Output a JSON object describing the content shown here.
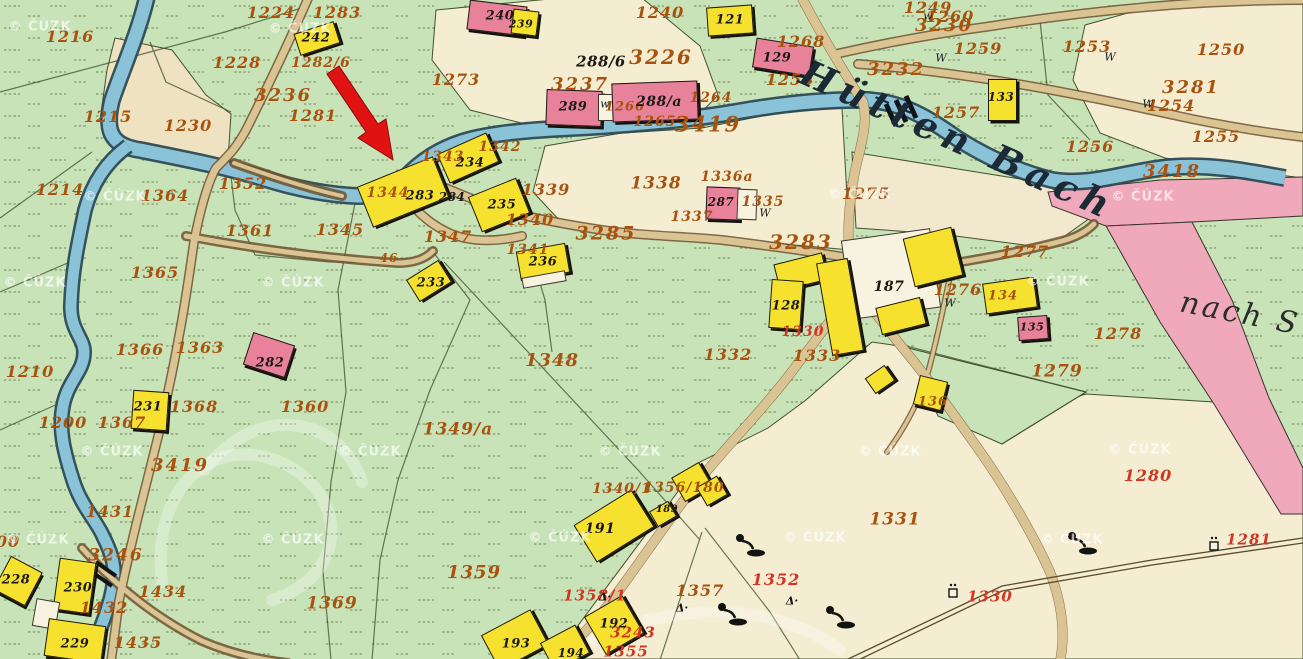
{
  "map": {
    "stream_name": "Hütten Bach",
    "road_destination": "nach S",
    "watermark_text": "© ČÚZK",
    "palette": {
      "meadow_green": "#c9e3b8",
      "field_cream": "#f4edd2",
      "field_tan": "#efe2c0",
      "road_fill": "#dbc493",
      "road_edge": "#6f522f",
      "stream_fill": "#8ac2d8",
      "stream_edge": "#2c4a55",
      "highway_pink": "#f0a9ba",
      "building_wood_yellow": "#f6e22e",
      "building_masonry_pink": "#e8819a",
      "ink_parcel_orange": "#a8520e",
      "ink_revision_red": "#d03622",
      "ink_house_black": "#1b1915",
      "annotation_arrow_red": "#e01212"
    },
    "annotation_arrow": {
      "points": "327,74 339,66 378,124 386,119 393,160 358,138 366,132",
      "color": "#e01212"
    },
    "labels": [
      {
        "t": "1216",
        "x": 70,
        "y": 37,
        "c": "o"
      },
      {
        "t": "1224",
        "x": 271,
        "y": 13,
        "c": "o"
      },
      {
        "t": "1283",
        "x": 337,
        "y": 13,
        "c": "o"
      },
      {
        "t": "1228",
        "x": 237,
        "y": 63,
        "c": "o"
      },
      {
        "t": "1282/6",
        "x": 321,
        "y": 63,
        "c": "o",
        "s": 14
      },
      {
        "t": "1281",
        "x": 313,
        "y": 116,
        "c": "o"
      },
      {
        "t": "1215",
        "x": 108,
        "y": 117,
        "c": "o"
      },
      {
        "t": "1230",
        "x": 188,
        "y": 126,
        "c": "o"
      },
      {
        "t": "1273",
        "x": 456,
        "y": 80,
        "c": "o"
      },
      {
        "t": "1214",
        "x": 60,
        "y": 190,
        "c": "o"
      },
      {
        "t": "1364",
        "x": 165,
        "y": 196,
        "c": "o"
      },
      {
        "t": "1352",
        "x": 243,
        "y": 184,
        "c": "o"
      },
      {
        "t": "1361",
        "x": 250,
        "y": 231,
        "c": "o"
      },
      {
        "t": "1345",
        "x": 340,
        "y": 230,
        "c": "o"
      },
      {
        "t": "1365",
        "x": 155,
        "y": 273,
        "c": "o"
      },
      {
        "t": "1366",
        "x": 140,
        "y": 350,
        "c": "o"
      },
      {
        "t": "1363",
        "x": 200,
        "y": 348,
        "c": "o"
      },
      {
        "t": "1360",
        "x": 305,
        "y": 407,
        "c": "o"
      },
      {
        "t": "1367",
        "x": 122,
        "y": 423,
        "c": "o"
      },
      {
        "t": "1368",
        "x": 194,
        "y": 407,
        "c": "o"
      },
      {
        "t": "1200",
        "x": 63,
        "y": 423,
        "c": "o"
      },
      {
        "t": "1431",
        "x": 110,
        "y": 512,
        "c": "o"
      },
      {
        "t": "1434",
        "x": 163,
        "y": 592,
        "c": "o"
      },
      {
        "t": "1435",
        "x": 138,
        "y": 643,
        "c": "o"
      },
      {
        "t": "1432",
        "x": 104,
        "y": 608,
        "c": "o"
      },
      {
        "t": "1369",
        "x": 332,
        "y": 604,
        "c": "o",
        "s": 17
      },
      {
        "t": "1210",
        "x": 30,
        "y": 372,
        "c": "o"
      },
      {
        "t": "00",
        "x": 8,
        "y": 542,
        "c": "o"
      },
      {
        "t": "1348",
        "x": 552,
        "y": 361,
        "c": "o",
        "s": 18
      },
      {
        "t": "1349/a",
        "x": 458,
        "y": 430,
        "c": "o",
        "s": 17
      },
      {
        "t": "1359",
        "x": 474,
        "y": 573,
        "c": "o",
        "s": 18
      },
      {
        "t": "1340/1",
        "x": 622,
        "y": 489,
        "c": "o",
        "s": 14
      },
      {
        "t": "1356/180",
        "x": 684,
        "y": 488,
        "c": "o",
        "s": 14
      },
      {
        "t": "1357",
        "x": 700,
        "y": 591,
        "c": "o"
      },
      {
        "t": "1331",
        "x": 895,
        "y": 520,
        "c": "o",
        "s": 17
      },
      {
        "t": "1339",
        "x": 546,
        "y": 190,
        "c": "o"
      },
      {
        "t": "1340",
        "x": 530,
        "y": 220,
        "c": "o"
      },
      {
        "t": "1347",
        "x": 448,
        "y": 237,
        "c": "o"
      },
      {
        "t": "1341",
        "x": 528,
        "y": 250,
        "c": "o",
        "s": 14
      },
      {
        "t": "1343",
        "x": 443,
        "y": 157,
        "c": "o",
        "s": 14
      },
      {
        "t": "1342",
        "x": 500,
        "y": 147,
        "c": "o",
        "s": 14
      },
      {
        "t": "1344",
        "x": 388,
        "y": 193,
        "c": "o",
        "s": 14
      },
      {
        "t": "1338",
        "x": 656,
        "y": 184,
        "c": "o",
        "s": 17
      },
      {
        "t": "1336a",
        "x": 727,
        "y": 177,
        "c": "o",
        "s": 14
      },
      {
        "t": "1337",
        "x": 692,
        "y": 217,
        "c": "o",
        "s": 14
      },
      {
        "t": "1335",
        "x": 763,
        "y": 202,
        "c": "o",
        "s": 14
      },
      {
        "t": "1275",
        "x": 866,
        "y": 194,
        "c": "o"
      },
      {
        "t": "1277",
        "x": 1025,
        "y": 252,
        "c": "o"
      },
      {
        "t": "1278",
        "x": 1118,
        "y": 334,
        "c": "o"
      },
      {
        "t": "1279",
        "x": 1057,
        "y": 372,
        "c": "o",
        "s": 17
      },
      {
        "t": "1332",
        "x": 728,
        "y": 355,
        "c": "o"
      },
      {
        "t": "1333",
        "x": 817,
        "y": 356,
        "c": "o"
      },
      {
        "t": "1268",
        "x": 801,
        "y": 42,
        "c": "o"
      },
      {
        "t": "1240",
        "x": 660,
        "y": 13,
        "c": "o"
      },
      {
        "t": "1258",
        "x": 790,
        "y": 80,
        "c": "o"
      },
      {
        "t": "1249",
        "x": 928,
        "y": 8,
        "c": "o"
      },
      {
        "t": "1260",
        "x": 950,
        "y": 17,
        "c": "o"
      },
      {
        "t": "1259",
        "x": 978,
        "y": 49,
        "c": "o"
      },
      {
        "t": "1253",
        "x": 1087,
        "y": 47,
        "c": "o"
      },
      {
        "t": "1250",
        "x": 1221,
        "y": 50,
        "c": "o"
      },
      {
        "t": "1254",
        "x": 1171,
        "y": 106,
        "c": "o"
      },
      {
        "t": "1257",
        "x": 956,
        "y": 113,
        "c": "o"
      },
      {
        "t": "1256",
        "x": 1090,
        "y": 147,
        "c": "o"
      },
      {
        "t": "1255",
        "x": 1216,
        "y": 137,
        "c": "o"
      },
      {
        "t": "1264",
        "x": 711,
        "y": 98,
        "c": "o",
        "s": 14
      },
      {
        "t": "1265",
        "x": 655,
        "y": 122,
        "c": "o",
        "s": 14
      },
      {
        "t": "1266",
        "x": 625,
        "y": 107,
        "c": "o",
        "s": 13
      },
      {
        "t": "1276",
        "x": 958,
        "y": 290,
        "c": "o"
      },
      {
        "t": "136",
        "x": 933,
        "y": 402,
        "c": "o",
        "s": 13
      },
      {
        "t": "134",
        "x": 1003,
        "y": 296,
        "c": "o",
        "s": 13
      },
      {
        "t": "46",
        "x": 389,
        "y": 258,
        "c": "o",
        "s": 12
      },
      {
        "t": "3236",
        "x": 283,
        "y": 96,
        "c": "O",
        "s": 18
      },
      {
        "t": "3226",
        "x": 661,
        "y": 57,
        "c": "O"
      },
      {
        "t": "3237",
        "x": 580,
        "y": 85,
        "c": "O",
        "s": 18
      },
      {
        "t": "3419",
        "x": 708,
        "y": 124,
        "c": "O",
        "s": 21
      },
      {
        "t": "3419",
        "x": 180,
        "y": 466,
        "c": "O",
        "s": 18
      },
      {
        "t": "3285",
        "x": 606,
        "y": 234,
        "c": "O",
        "s": 19
      },
      {
        "t": "3283",
        "x": 801,
        "y": 242,
        "c": "O"
      },
      {
        "t": "3230",
        "x": 944,
        "y": 26,
        "c": "O",
        "s": 18
      },
      {
        "t": "3232",
        "x": 896,
        "y": 70,
        "c": "O",
        "s": 18
      },
      {
        "t": "3281",
        "x": 1191,
        "y": 88,
        "c": "O",
        "s": 18
      },
      {
        "t": "3418",
        "x": 1172,
        "y": 172,
        "c": "O",
        "s": 18
      },
      {
        "t": "3246",
        "x": 116,
        "y": 556,
        "c": "O",
        "s": 17
      },
      {
        "t": "1352",
        "x": 776,
        "y": 580,
        "c": "r",
        "s": 16
      },
      {
        "t": "1355",
        "x": 626,
        "y": 652,
        "c": "r"
      },
      {
        "t": "3243",
        "x": 633,
        "y": 633,
        "c": "r"
      },
      {
        "t": "1330",
        "x": 990,
        "y": 597,
        "c": "r"
      },
      {
        "t": "1330",
        "x": 803,
        "y": 332,
        "c": "r",
        "s": 14
      },
      {
        "t": "1280",
        "x": 1148,
        "y": 476,
        "c": "r",
        "s": 16
      },
      {
        "t": "1281",
        "x": 1249,
        "y": 540,
        "c": "r"
      },
      {
        "t": "1358/1",
        "x": 595,
        "y": 596,
        "c": "r"
      },
      {
        "t": "242",
        "x": 316,
        "y": 38,
        "c": "b"
      },
      {
        "t": "240",
        "x": 500,
        "y": 16,
        "c": "b"
      },
      {
        "t": "239",
        "x": 521,
        "y": 24,
        "c": "b",
        "s": 11
      },
      {
        "t": "121",
        "x": 730,
        "y": 20,
        "c": "b"
      },
      {
        "t": "129",
        "x": 777,
        "y": 58,
        "c": "b"
      },
      {
        "t": "133",
        "x": 1001,
        "y": 97,
        "c": "b",
        "s": 12
      },
      {
        "t": "289",
        "x": 573,
        "y": 107,
        "c": "b"
      },
      {
        "t": "287",
        "x": 721,
        "y": 202,
        "c": "b",
        "s": 12
      },
      {
        "t": "283",
        "x": 420,
        "y": 196,
        "c": "b"
      },
      {
        "t": "284",
        "x": 452,
        "y": 197,
        "c": "b",
        "s": 12
      },
      {
        "t": "234",
        "x": 470,
        "y": 163,
        "c": "b"
      },
      {
        "t": "235",
        "x": 502,
        "y": 205,
        "c": "b"
      },
      {
        "t": "236",
        "x": 543,
        "y": 262,
        "c": "b"
      },
      {
        "t": "233",
        "x": 431,
        "y": 283,
        "c": "b"
      },
      {
        "t": "282",
        "x": 270,
        "y": 363,
        "c": "b"
      },
      {
        "t": "231",
        "x": 148,
        "y": 407,
        "c": "b"
      },
      {
        "t": "228",
        "x": 16,
        "y": 580,
        "c": "b"
      },
      {
        "t": "230",
        "x": 78,
        "y": 588,
        "c": "b"
      },
      {
        "t": "229",
        "x": 75,
        "y": 644,
        "c": "b"
      },
      {
        "t": "187",
        "x": 889,
        "y": 287,
        "c": "b",
        "s": 14
      },
      {
        "t": "128",
        "x": 786,
        "y": 306,
        "c": "b"
      },
      {
        "t": "135",
        "x": 1032,
        "y": 327,
        "c": "b",
        "s": 11
      },
      {
        "t": "191",
        "x": 600,
        "y": 529,
        "c": "b",
        "s": 14
      },
      {
        "t": "192",
        "x": 614,
        "y": 624,
        "c": "b"
      },
      {
        "t": "193",
        "x": 516,
        "y": 644,
        "c": "b"
      },
      {
        "t": "194",
        "x": 571,
        "y": 653,
        "c": "b",
        "s": 12
      },
      {
        "t": "189",
        "x": 667,
        "y": 510,
        "c": "b",
        "s": 10
      },
      {
        "t": "288/6",
        "x": 601,
        "y": 62,
        "c": "B"
      },
      {
        "t": "288/a",
        "x": 659,
        "y": 102,
        "c": "B",
        "s": 14
      },
      {
        "t": "w",
        "x": 928,
        "y": 16,
        "c": "W"
      },
      {
        "t": "W",
        "x": 941,
        "y": 58,
        "c": "W"
      },
      {
        "t": "W",
        "x": 1110,
        "y": 57,
        "c": "W"
      },
      {
        "t": "W",
        "x": 1148,
        "y": 104,
        "c": "W"
      },
      {
        "t": "W",
        "x": 950,
        "y": 303,
        "c": "W"
      },
      {
        "t": "W",
        "x": 765,
        "y": 213,
        "c": "W"
      },
      {
        "t": "w",
        "x": 605,
        "y": 104,
        "c": "W"
      },
      {
        "t": "Δ·",
        "x": 605,
        "y": 597,
        "c": "sym"
      },
      {
        "t": "Δ·",
        "x": 682,
        "y": 608,
        "c": "sym"
      },
      {
        "t": "Δ·",
        "x": 792,
        "y": 601,
        "c": "sym"
      },
      {
        "t": "Hütten Bach",
        "x": 958,
        "y": 140,
        "c": "s",
        "r": 24
      },
      {
        "t": "nach S",
        "x": 1240,
        "y": 314,
        "c": "s2",
        "r": 11
      }
    ],
    "buildings": [
      {
        "x": 846,
        "y": 234,
        "w": 88,
        "h": 78,
        "r": -8,
        "c": "w"
      },
      {
        "x": 296,
        "y": 27,
        "w": 40,
        "h": 21,
        "r": -18,
        "c": "y"
      },
      {
        "x": 468,
        "y": 3,
        "w": 56,
        "h": 28,
        "r": 7,
        "c": "p"
      },
      {
        "x": 512,
        "y": 10,
        "w": 24,
        "h": 23,
        "r": 7,
        "c": "y"
      },
      {
        "x": 707,
        "y": 6,
        "w": 44,
        "h": 27,
        "r": -4,
        "c": "y"
      },
      {
        "x": 754,
        "y": 42,
        "w": 56,
        "h": 28,
        "r": 9,
        "c": "p"
      },
      {
        "x": 988,
        "y": 79,
        "w": 27,
        "h": 40,
        "r": 0,
        "c": "y"
      },
      {
        "x": 546,
        "y": 90,
        "w": 54,
        "h": 34,
        "r": 2,
        "c": "p"
      },
      {
        "x": 598,
        "y": 94,
        "w": 16,
        "h": 25,
        "r": 0,
        "c": "w"
      },
      {
        "x": 612,
        "y": 82,
        "w": 84,
        "h": 37,
        "r": -2,
        "c": "p"
      },
      {
        "x": 706,
        "y": 187,
        "w": 32,
        "h": 31,
        "r": 2,
        "c": "p"
      },
      {
        "x": 737,
        "y": 189,
        "w": 18,
        "h": 29,
        "r": 2,
        "c": "w"
      },
      {
        "x": 362,
        "y": 170,
        "w": 80,
        "h": 42,
        "r": -22,
        "c": "y"
      },
      {
        "x": 441,
        "y": 142,
        "w": 52,
        "h": 30,
        "r": -24,
        "c": "y"
      },
      {
        "x": 473,
        "y": 186,
        "w": 50,
        "h": 36,
        "r": -22,
        "c": "y"
      },
      {
        "x": 518,
        "y": 247,
        "w": 48,
        "h": 28,
        "r": -10,
        "c": "y"
      },
      {
        "x": 522,
        "y": 274,
        "w": 42,
        "h": 9,
        "r": -10,
        "c": "w"
      },
      {
        "x": 410,
        "y": 268,
        "w": 36,
        "h": 24,
        "r": -32,
        "c": "y"
      },
      {
        "x": 247,
        "y": 338,
        "w": 42,
        "h": 32,
        "r": 18,
        "c": "p"
      },
      {
        "x": 132,
        "y": 391,
        "w": 34,
        "h": 37,
        "r": 4,
        "c": "y"
      },
      {
        "x": 0,
        "y": 562,
        "w": 34,
        "h": 36,
        "r": 28,
        "c": "y"
      },
      {
        "x": 56,
        "y": 560,
        "w": 35,
        "h": 50,
        "r": 8,
        "c": "y"
      },
      {
        "x": 34,
        "y": 600,
        "w": 22,
        "h": 26,
        "r": 10,
        "c": "w"
      },
      {
        "x": 46,
        "y": 622,
        "w": 56,
        "h": 36,
        "r": 8,
        "c": "y"
      },
      {
        "x": 776,
        "y": 258,
        "w": 48,
        "h": 26,
        "r": -14,
        "c": "y"
      },
      {
        "x": 824,
        "y": 260,
        "w": 30,
        "h": 92,
        "r": -10,
        "c": "y"
      },
      {
        "x": 908,
        "y": 232,
        "w": 48,
        "h": 48,
        "r": -14,
        "c": "y"
      },
      {
        "x": 878,
        "y": 302,
        "w": 44,
        "h": 26,
        "r": -14,
        "c": "y"
      },
      {
        "x": 770,
        "y": 280,
        "w": 30,
        "h": 47,
        "r": 4,
        "c": "y"
      },
      {
        "x": 984,
        "y": 280,
        "w": 50,
        "h": 29,
        "r": -8,
        "c": "y"
      },
      {
        "x": 1018,
        "y": 316,
        "w": 28,
        "h": 22,
        "r": -4,
        "c": "p"
      },
      {
        "x": 916,
        "y": 378,
        "w": 27,
        "h": 28,
        "r": 14,
        "c": "y"
      },
      {
        "x": 580,
        "y": 504,
        "w": 66,
        "h": 42,
        "r": -32,
        "c": "y"
      },
      {
        "x": 592,
        "y": 603,
        "w": 42,
        "h": 42,
        "r": -30,
        "c": "y"
      },
      {
        "x": 487,
        "y": 620,
        "w": 54,
        "h": 38,
        "r": -28,
        "c": "y"
      },
      {
        "x": 545,
        "y": 632,
        "w": 38,
        "h": 30,
        "r": -28,
        "c": "y"
      },
      {
        "x": 676,
        "y": 468,
        "w": 30,
        "h": 26,
        "r": -30,
        "c": "y"
      },
      {
        "x": 700,
        "y": 480,
        "w": 22,
        "h": 20,
        "r": -30,
        "c": "y"
      },
      {
        "x": 652,
        "y": 505,
        "w": 20,
        "h": 16,
        "r": -30,
        "c": "y"
      },
      {
        "x": 868,
        "y": 370,
        "w": 22,
        "h": 17,
        "r": -35,
        "c": "y"
      }
    ],
    "watermark_positions": [
      [
        40,
        27
      ],
      [
        300,
        29
      ],
      [
        115,
        197
      ],
      [
        860,
        195
      ],
      [
        1143,
        197
      ],
      [
        35,
        283
      ],
      [
        293,
        283
      ],
      [
        1058,
        282
      ],
      [
        112,
        452
      ],
      [
        370,
        452
      ],
      [
        630,
        452
      ],
      [
        890,
        452
      ],
      [
        1140,
        450
      ],
      [
        38,
        540
      ],
      [
        293,
        540
      ],
      [
        560,
        538
      ],
      [
        815,
        538
      ],
      [
        1072,
        540
      ]
    ],
    "wells": [
      [
        748,
        545
      ],
      [
        730,
        614
      ],
      [
        838,
        617
      ],
      [
        1080,
        543
      ]
    ],
    "boundary_markers": [
      [
        953,
        592
      ],
      [
        1214,
        545
      ]
    ]
  }
}
